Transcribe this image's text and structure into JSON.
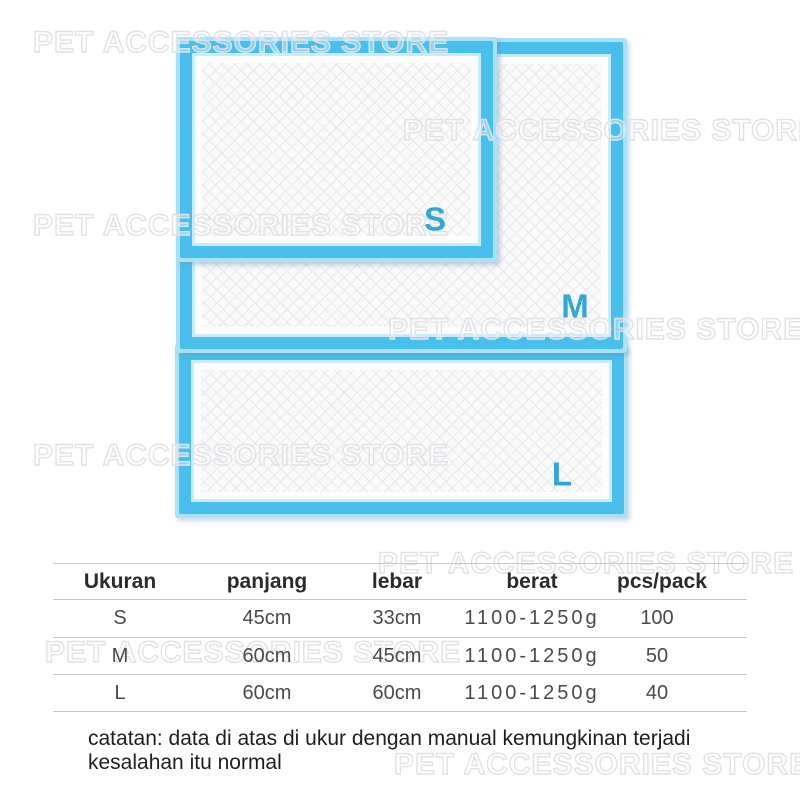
{
  "watermark": {
    "text": "PET ACCESSORIES STORE",
    "positions": [
      {
        "x": 33,
        "y": 28
      },
      {
        "x": 403,
        "y": 116
      },
      {
        "x": 33,
        "y": 211
      },
      {
        "x": 388,
        "y": 315
      },
      {
        "x": 33,
        "y": 441
      },
      {
        "x": 378,
        "y": 549
      },
      {
        "x": 45,
        "y": 638
      },
      {
        "x": 394,
        "y": 750
      }
    ]
  },
  "pads": {
    "s": {
      "label": "S"
    },
    "m": {
      "label": "M"
    },
    "l": {
      "label": "L"
    }
  },
  "size_table": {
    "headers": [
      "Ukuran",
      "panjang",
      "lebar",
      "berat",
      "pcs/pack"
    ],
    "rows": [
      [
        "S",
        "45cm",
        "33cm",
        "1100-1250g",
        "100"
      ],
      [
        "M",
        "60cm",
        "45cm",
        "1100-1250g",
        "50"
      ],
      [
        "L",
        "60cm",
        "60cm",
        "1100-1250g",
        "40"
      ]
    ]
  },
  "note": {
    "line1": "catatan: data di atas di ukur dengan manual kemungkinan terjadi",
    "line2": "kesalahan itu normal"
  },
  "colors": {
    "pad_border": "#49bfee",
    "pad_border_light": "#a9e2f8",
    "label_blue": "#2fa7d9",
    "watermark_stroke": "#e2e2e6",
    "table_line": "#c6c6c6"
  }
}
